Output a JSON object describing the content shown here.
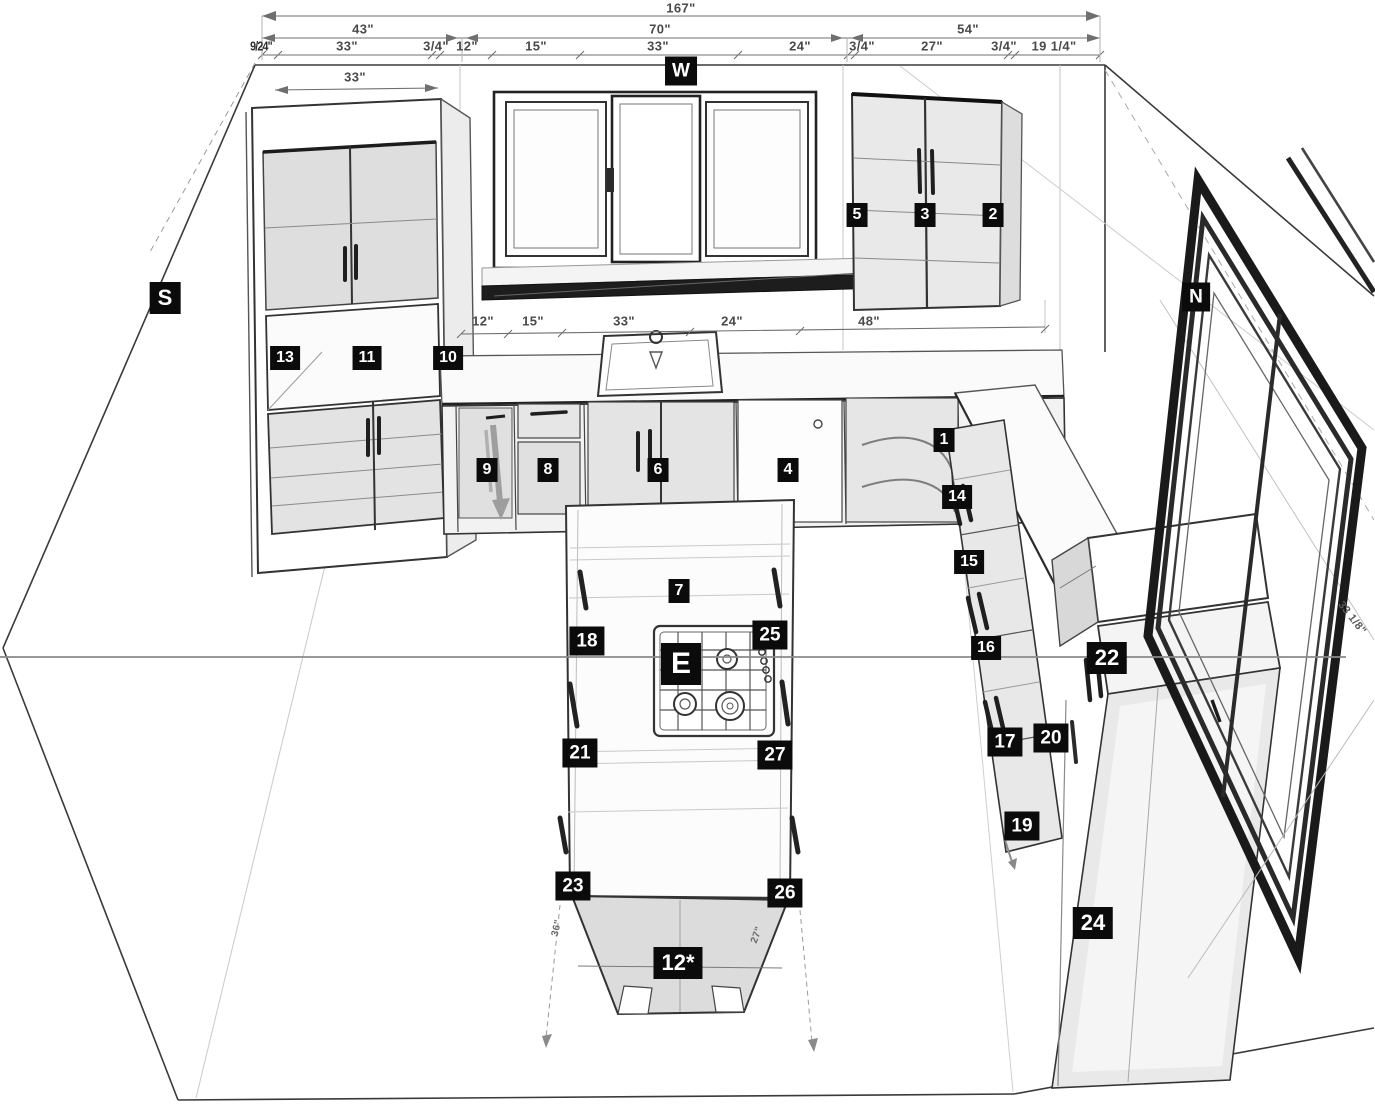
{
  "compass": {
    "w": "W",
    "s": "S",
    "n": "N",
    "e": "E"
  },
  "tags": {
    "n1": "1",
    "n2": "2",
    "n3": "3",
    "n4": "4",
    "n5": "5",
    "n6": "6",
    "n7": "7",
    "n8": "8",
    "n9": "9",
    "n10": "10",
    "n11": "11",
    "n12": "12*",
    "n13": "13",
    "n14": "14",
    "n15": "15",
    "n16": "16",
    "n17": "17",
    "n18": "18",
    "n19": "19",
    "n20": "20",
    "n21": "21",
    "n22": "22",
    "n23": "23",
    "n24": "24",
    "n25": "25",
    "n26": "26",
    "n27": "27"
  },
  "dimensions": {
    "overall": "167\"",
    "row2": [
      "43\"",
      "70\"",
      "54\""
    ],
    "row3": [
      "9/24\"",
      "33\"",
      "3/4\"",
      "12\"",
      "15\"",
      "33\"",
      "24\"",
      "3/4\"",
      "27\"",
      "3/4\"",
      "19 1/4\""
    ],
    "cabinet_width": "33\"",
    "window_row": [
      "12\"",
      "15\"",
      "33\"",
      "24\"",
      "48\""
    ],
    "island_left": "36\"",
    "island_right": "27\"",
    "wall_right": "33 1/8\""
  }
}
